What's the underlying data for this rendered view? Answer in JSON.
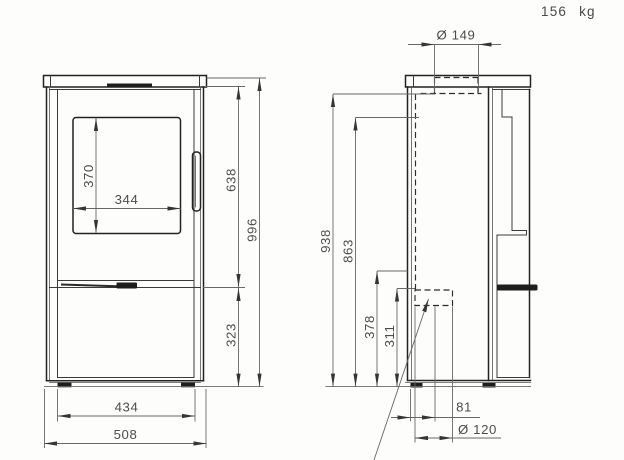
{
  "weight_label": "156 kg",
  "front_view": {
    "glass_height": "370",
    "glass_width": "344",
    "door_top_height": "638",
    "total_height": "996",
    "base_height": "323",
    "feet_width": "434",
    "total_width": "508"
  },
  "side_view": {
    "top_flue_diameter": "Ø 149",
    "flue_top_height": "938",
    "flue_rear_height": "863",
    "rear_outlet_top_height": "378",
    "rear_outlet_bottom_height": "311",
    "rear_outlet_offset": "81",
    "rear_outlet_diameter": "Ø 120"
  }
}
